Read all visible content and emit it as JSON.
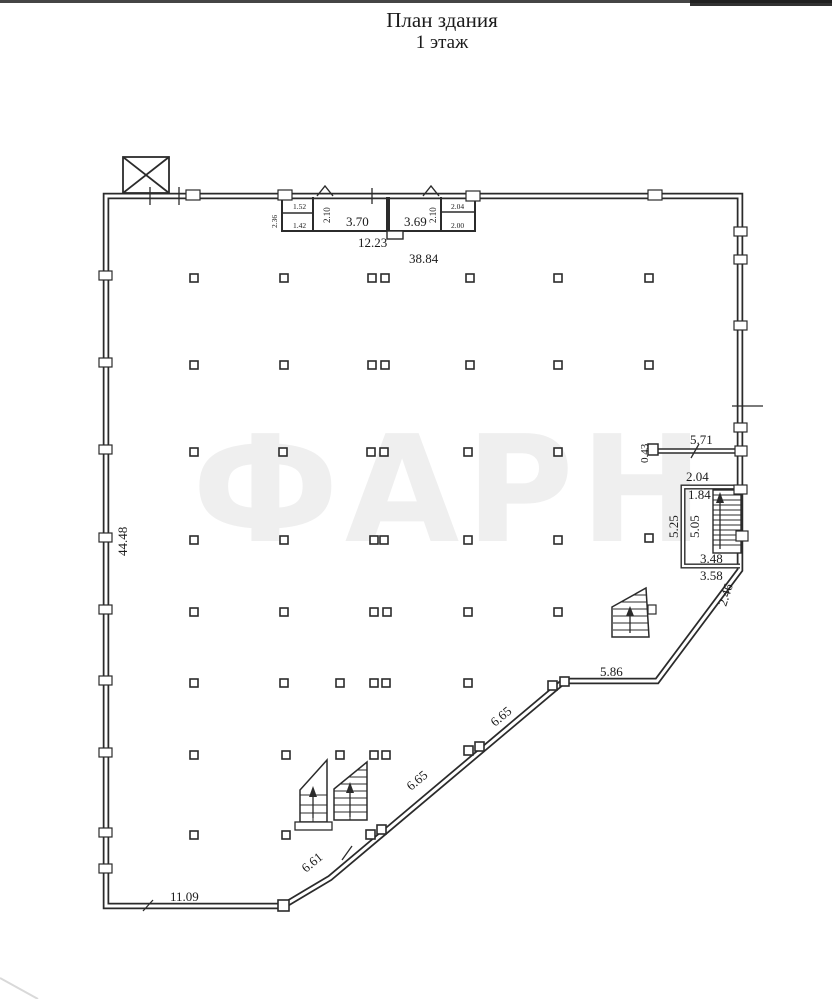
{
  "title": {
    "line1": "План здания",
    "line2": "1 этаж"
  },
  "watermark": "ФАРН",
  "dims": {
    "left_height": "44.48",
    "top_inner": "12.23",
    "top_total": "38.84",
    "rooms": {
      "left_width": "2.36",
      "left_upper": "1.52",
      "left_lower": "1.42",
      "room1_depth": "2.10",
      "room1_width": "3.70",
      "room2_width": "3.69",
      "room2_depth": "2.10",
      "right_upper": "2.04",
      "right_lower": "2.00"
    },
    "right": {
      "ledge_offset": "0.43",
      "ledge_length": "5.71",
      "stair_top_outer": "2.04",
      "stair_top_inner": "1.84",
      "stair_side_outer": "5.25",
      "stair_side_inner": "5.05",
      "stair_bottom_inner": "3.48",
      "stair_bottom_outer": "3.58",
      "corner_diag": "2.46"
    },
    "bottom": {
      "bottom_wall": "11.09",
      "diag_lower": "6.61",
      "diag_mid": "6.65",
      "diag_upper": "6.65",
      "notch": "5.86"
    }
  }
}
